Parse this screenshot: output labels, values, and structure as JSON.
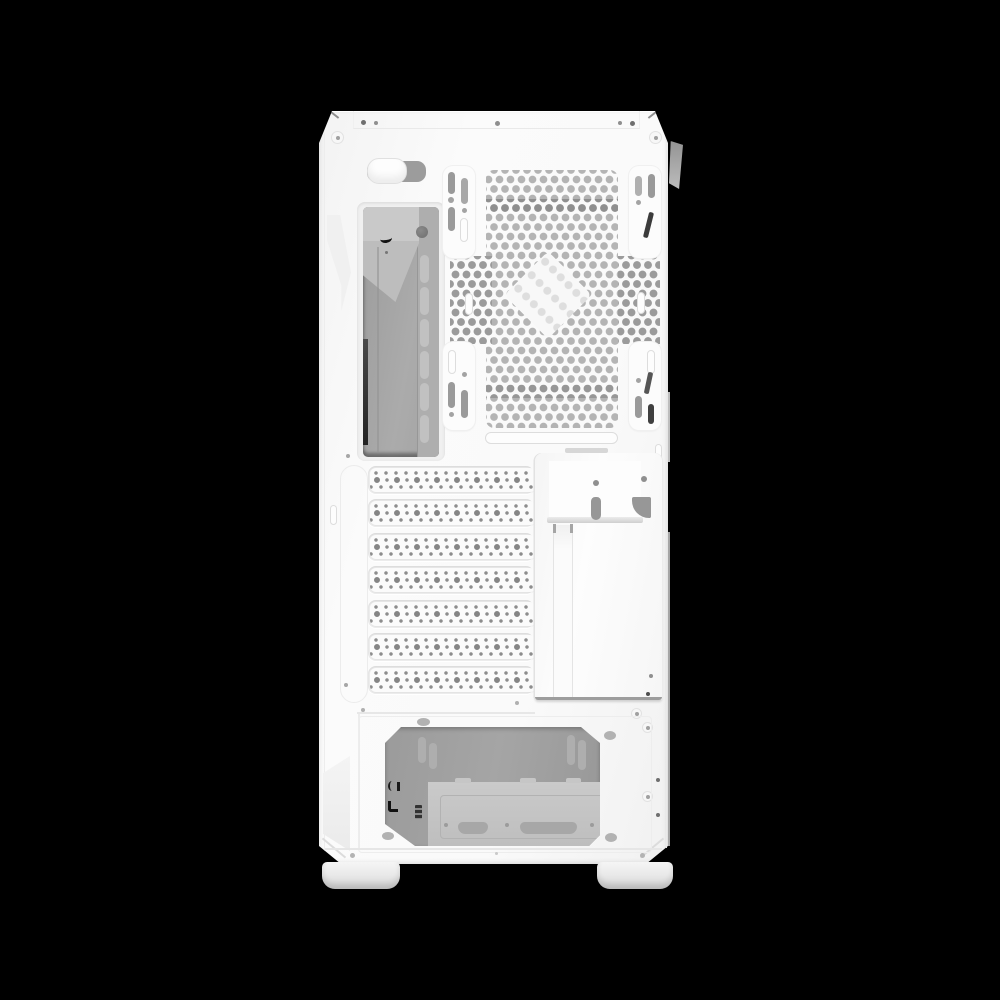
{
  "scene": {
    "subject": "rear view of a white mid-tower PC case on a black background",
    "background_color": "#000000"
  },
  "palette": {
    "background": "#000000",
    "case_white": "#fafafa",
    "vent_hole": "#b4b4b4",
    "vent_hole_dark": "#8f8f8f",
    "slot_gray": "#9a9a9a",
    "interior_gray": "#a4a4a4",
    "psu_interior": "#9e9e9e",
    "side_tab_gray": "#9c9c9c"
  },
  "counts": {
    "pci_slots": 7,
    "vertical_gpu_channels": 3,
    "io_wall_vents": 6,
    "fan_rails": 4,
    "feet": 2
  }
}
